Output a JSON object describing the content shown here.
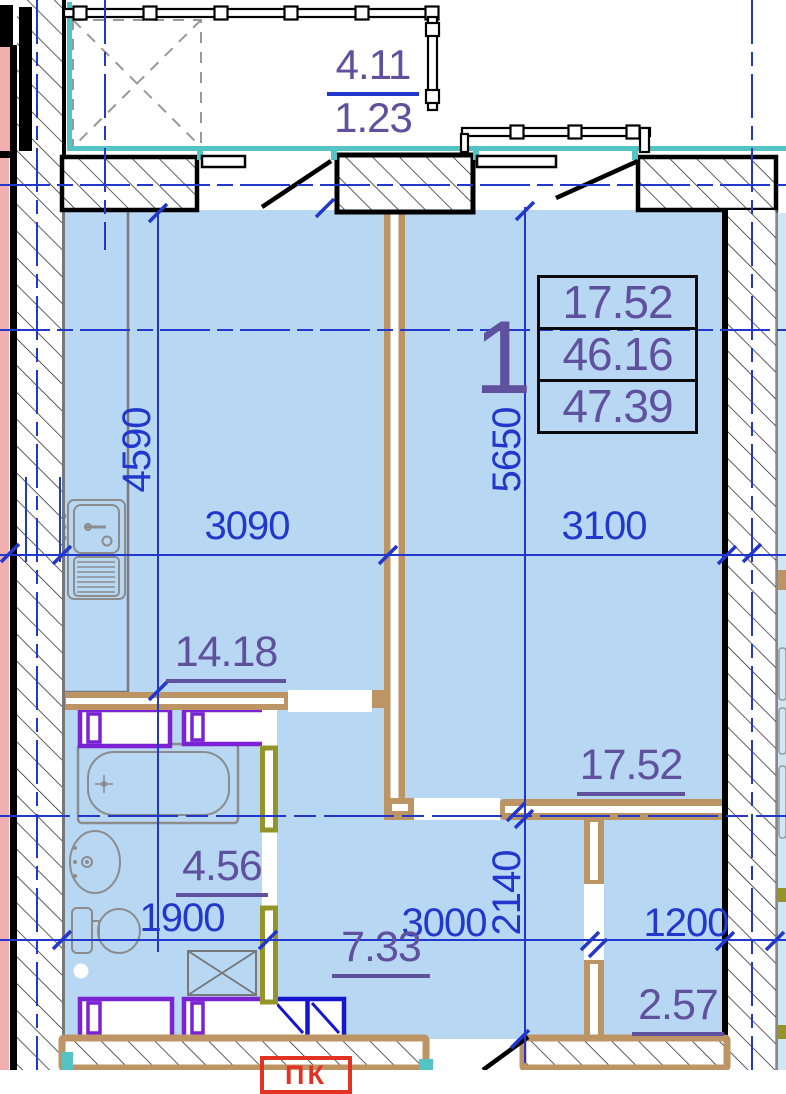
{
  "plan": {
    "unit_label": "1",
    "info_box": {
      "rows": [
        "17.52",
        "46.16",
        "47.39"
      ]
    },
    "balcony": {
      "numerator": "4.11",
      "denominator": "1.23"
    },
    "rooms": {
      "kitchen_area": "14.18",
      "living_area": "17.52",
      "bath_area": "4.56",
      "hall_area": "7.33",
      "storage_area": "2.57"
    },
    "dimensions": {
      "kitchen_width": "3090",
      "living_width": "3100",
      "kitchen_height": "4590",
      "living_height": "5650",
      "bath_width": "1900",
      "hall_width": "3000",
      "storage_width": "1200",
      "storage_height": "2140"
    },
    "stamp": "ПК"
  },
  "colors": {
    "dimBlue": "#2238cc",
    "purple": "#5f519e",
    "tan": "#bd9565",
    "olive": "#95942b",
    "teal": "#53c3c3",
    "pink": "#f2afaf",
    "roomBlue": "#b7d7f3",
    "violet": "#7a22d4",
    "frameBlue": "#1616d0",
    "red": "#e23222",
    "fixGray": "#8c8c8c"
  }
}
